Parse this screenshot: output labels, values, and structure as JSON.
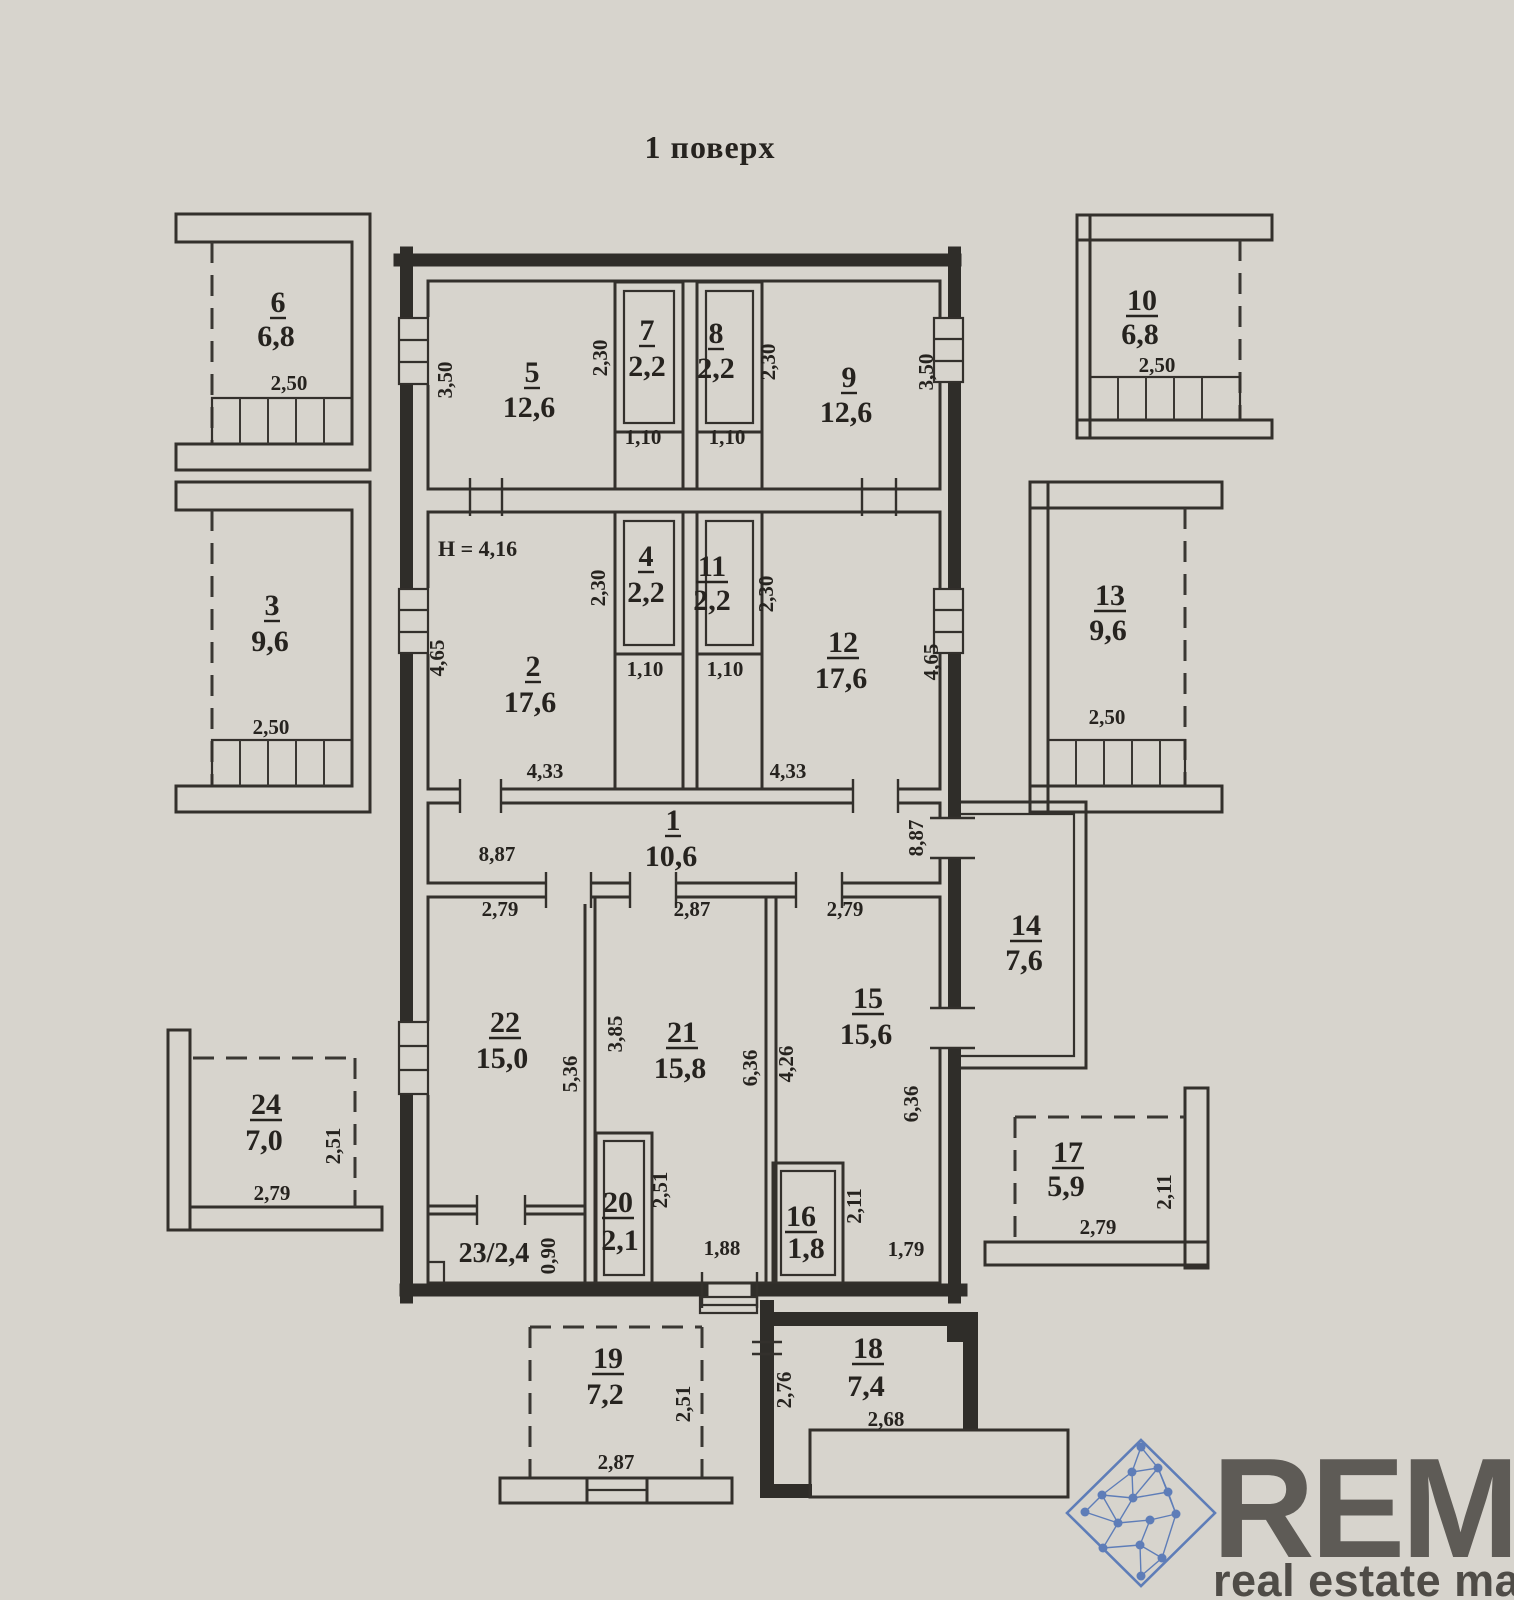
{
  "title": "1 поверх",
  "notes": {
    "height": "H = 4,16"
  },
  "rooms": {
    "r1": {
      "n": "1",
      "a": "10,6"
    },
    "r2": {
      "n": "2",
      "a": "17,6"
    },
    "r3": {
      "n": "3",
      "a": "9,6"
    },
    "r4": {
      "n": "4",
      "a": "2,2"
    },
    "r5": {
      "n": "5",
      "a": "12,6"
    },
    "r6": {
      "n": "6",
      "a": "6,8"
    },
    "r7": {
      "n": "7",
      "a": "2,2"
    },
    "r8": {
      "n": "8",
      "a": "2,2"
    },
    "r9": {
      "n": "9",
      "a": "12,6"
    },
    "r10": {
      "n": "10",
      "a": "6,8"
    },
    "r11": {
      "n": "11",
      "a": "2,2"
    },
    "r12": {
      "n": "12",
      "a": "17,6"
    },
    "r13": {
      "n": "13",
      "a": "9,6"
    },
    "r14": {
      "n": "14",
      "a": "7,6"
    },
    "r15": {
      "n": "15",
      "a": "15,6"
    },
    "r16": {
      "n": "16",
      "a": "1,8"
    },
    "r17": {
      "n": "17",
      "a": "5,9"
    },
    "r18": {
      "n": "18",
      "a": "7,4"
    },
    "r19": {
      "n": "19",
      "a": "7,2"
    },
    "r20": {
      "n": "20",
      "a": "2,1"
    },
    "r21": {
      "n": "21",
      "a": "15,8"
    },
    "r22": {
      "n": "22",
      "a": "15,0"
    },
    "r23": {
      "n": "23",
      "a": "2,4",
      "label": "23/2,4"
    },
    "r24": {
      "n": "24",
      "a": "7,0"
    }
  },
  "dims": {
    "d350": "3,50",
    "d230": "2,30",
    "d110": "1,10",
    "d250": "2,50",
    "d465": "4,65",
    "d433": "4,33",
    "d887": "8,87",
    "d279": "2,79",
    "d287": "2,87",
    "d536": "5,36",
    "d385": "3,85",
    "d636": "6,36",
    "d426": "4,26",
    "d251": "2,51",
    "d090": "0,90",
    "d188": "1,88",
    "d179": "1,79",
    "d211": "2,11",
    "d276": "2,76",
    "d268": "2,68"
  },
  "watermark": {
    "brand": "REM",
    "tagline": "real estate map",
    "brand_color": "#9ec5e6",
    "tagline_color": "#ddcc47",
    "icon_color": "#4a6fb5",
    "icon": "network-diamond-logo"
  }
}
